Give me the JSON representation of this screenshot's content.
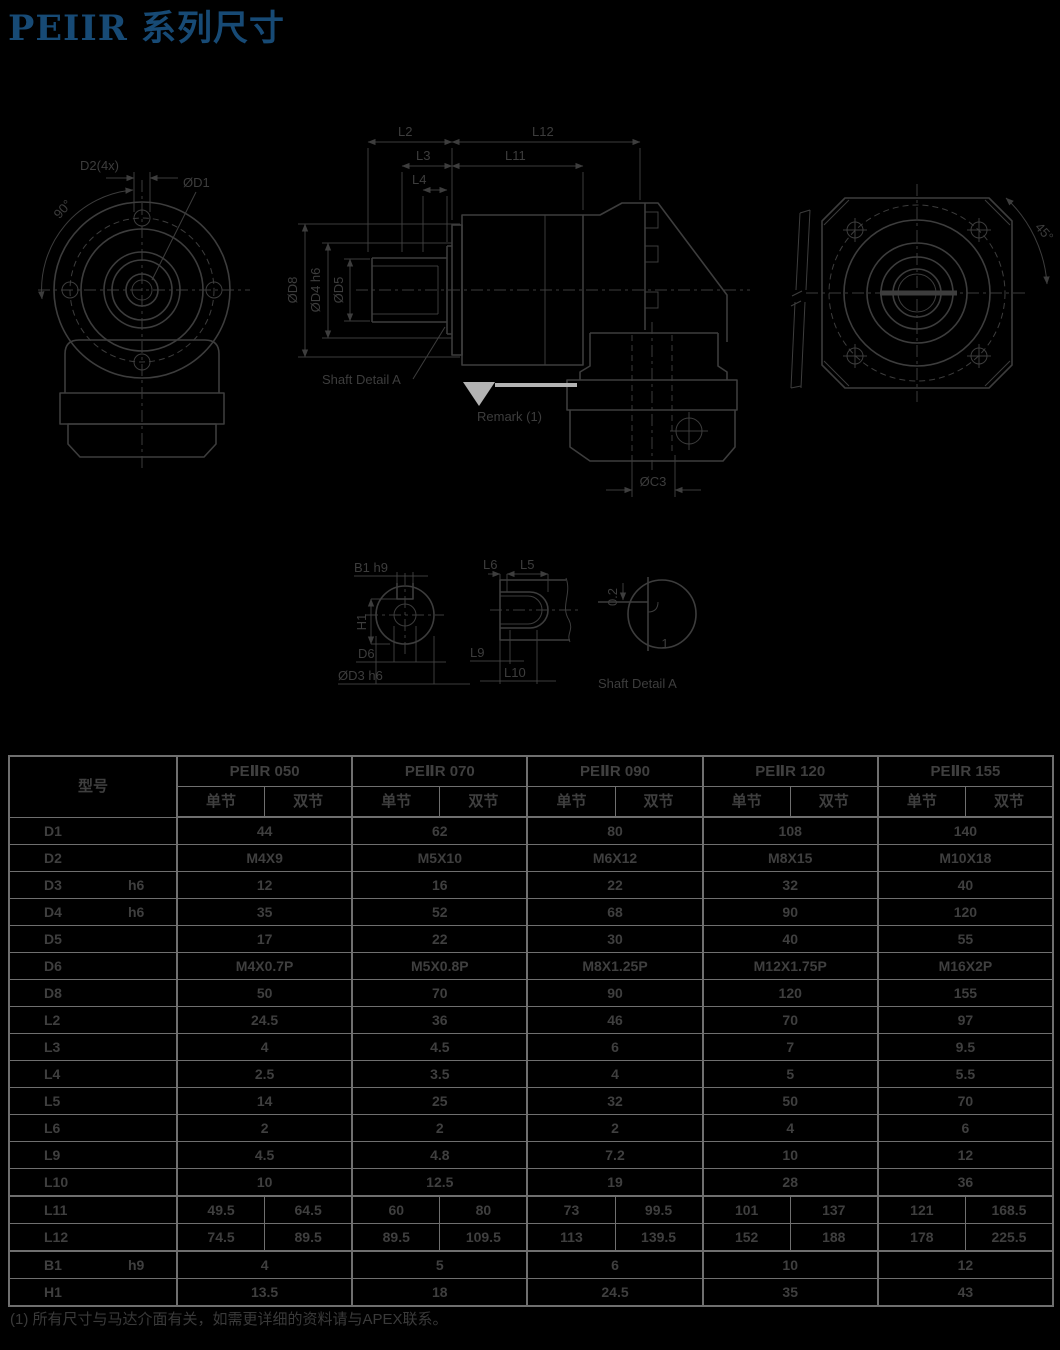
{
  "page": {
    "bg": "#000000",
    "accent": "#174a75",
    "title": "PEIIR 系列尺寸",
    "footnote": "(1) 所有尺寸与马达介面有关，如需更详细的资料请与APEX联系。"
  },
  "drawing_labels": {
    "front": {
      "d2": "D2(4x)",
      "d1": "ØD1",
      "angle90": "90°"
    },
    "side": {
      "l2": "L2",
      "l12": "L12",
      "l3": "L3",
      "l11": "L11",
      "l4": "L4",
      "d8": "ØD8",
      "d4": "ØD4 h6",
      "d5": "ØD5",
      "shaft_detail": "Shaft Detail A",
      "remark": "Remark (1)",
      "c3": "ØC3"
    },
    "rear": {
      "angle45": "45°"
    },
    "key_front": {
      "b1": "B1 h9",
      "h1": "H1",
      "d6": "D6",
      "d3": "ØD3 h6"
    },
    "key_side": {
      "l6": "L6",
      "l5": "L5",
      "l9": "L9",
      "l10": "L10"
    },
    "detail_a": {
      "r": "0.2",
      "c": "1",
      "caption": "Shaft  Detail  A"
    }
  },
  "table": {
    "model_header": "型号",
    "models": [
      "PEⅡR 050",
      "PEⅡR 070",
      "PEⅡR 090",
      "PEⅡR 120",
      "PEⅡR 155"
    ],
    "sub_headers": [
      "单节",
      "双节"
    ],
    "rows": [
      {
        "label": "D1",
        "tol": "",
        "values": [
          "44",
          "62",
          "80",
          "108",
          "140"
        ]
      },
      {
        "label": "D2",
        "tol": "",
        "values": [
          "M4X9",
          "M5X10",
          "M6X12",
          "M8X15",
          "M10X18"
        ]
      },
      {
        "label": "D3",
        "tol": "h6",
        "values": [
          "12",
          "16",
          "22",
          "32",
          "40"
        ]
      },
      {
        "label": "D4",
        "tol": "h6",
        "values": [
          "35",
          "52",
          "68",
          "90",
          "120"
        ]
      },
      {
        "label": "D5",
        "tol": "",
        "values": [
          "17",
          "22",
          "30",
          "40",
          "55"
        ]
      },
      {
        "label": "D6",
        "tol": "",
        "values": [
          "M4X0.7P",
          "M5X0.8P",
          "M8X1.25P",
          "M12X1.75P",
          "M16X2P"
        ]
      },
      {
        "label": "D8",
        "tol": "",
        "values": [
          "50",
          "70",
          "90",
          "120",
          "155"
        ]
      },
      {
        "label": "L2",
        "tol": "",
        "values": [
          "24.5",
          "36",
          "46",
          "70",
          "97"
        ]
      },
      {
        "label": "L3",
        "tol": "",
        "values": [
          "4",
          "4.5",
          "6",
          "7",
          "9.5"
        ]
      },
      {
        "label": "L4",
        "tol": "",
        "values": [
          "2.5",
          "3.5",
          "4",
          "5",
          "5.5"
        ]
      },
      {
        "label": "L5",
        "tol": "",
        "values": [
          "14",
          "25",
          "32",
          "50",
          "70"
        ]
      },
      {
        "label": "L6",
        "tol": "",
        "values": [
          "2",
          "2",
          "2",
          "4",
          "6"
        ]
      },
      {
        "label": "L9",
        "tol": "",
        "values": [
          "4.5",
          "4.8",
          "7.2",
          "10",
          "12"
        ]
      },
      {
        "label": "L10",
        "tol": "",
        "values": [
          "10",
          "12.5",
          "19",
          "28",
          "36"
        ]
      },
      {
        "label": "L11",
        "tol": "",
        "values": [
          [
            "49.5",
            "64.5"
          ],
          [
            "60",
            "80"
          ],
          [
            "73",
            "99.5"
          ],
          [
            "101",
            "137"
          ],
          [
            "121",
            "168.5"
          ]
        ]
      },
      {
        "label": "L12",
        "tol": "",
        "values": [
          [
            "74.5",
            "89.5"
          ],
          [
            "89.5",
            "109.5"
          ],
          [
            "113",
            "139.5"
          ],
          [
            "152",
            "188"
          ],
          [
            "178",
            "225.5"
          ]
        ]
      },
      {
        "label": "B1",
        "tol": "h9",
        "values": [
          "4",
          "5",
          "6",
          "10",
          "12"
        ]
      },
      {
        "label": "H1",
        "tol": "",
        "values": [
          "13.5",
          "18",
          "24.5",
          "35",
          "43"
        ]
      }
    ]
  }
}
